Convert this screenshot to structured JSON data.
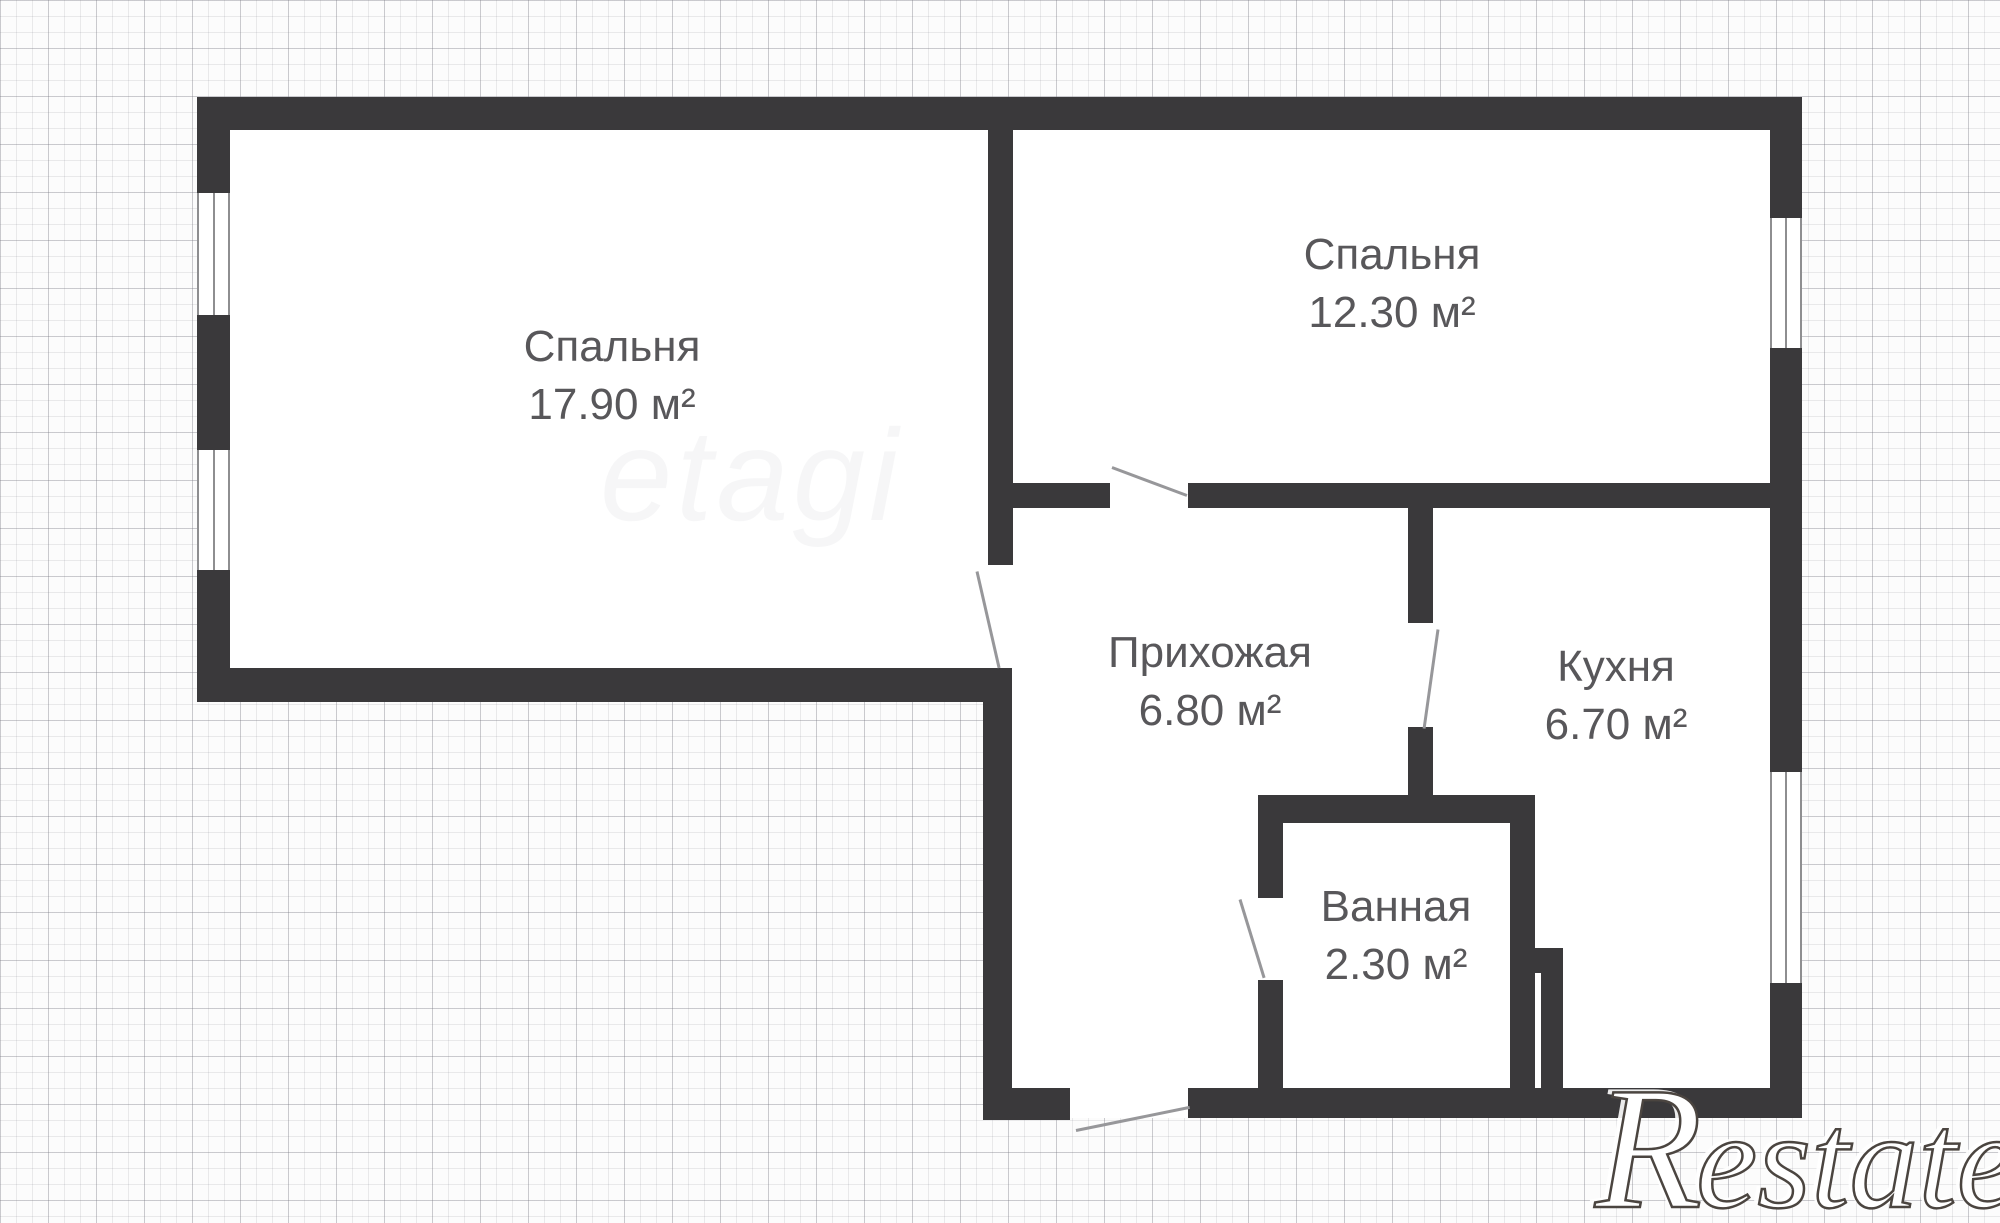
{
  "plan": {
    "rooms": [
      {
        "id": "bedroom-1",
        "name": "Спальня",
        "area": "17.90 м²"
      },
      {
        "id": "bedroom-2",
        "name": "Спальня",
        "area": "12.30 м²"
      },
      {
        "id": "hallway",
        "name": "Прихожая",
        "area": "6.80 м²"
      },
      {
        "id": "kitchen",
        "name": "Кухня",
        "area": "6.70 м²"
      },
      {
        "id": "bathroom",
        "name": "Ванная",
        "area": "2.30 м²"
      }
    ]
  },
  "watermarks": {
    "center": "etagi",
    "corner_initial": "R",
    "corner_rest": "estate"
  },
  "colors": {
    "wall": "#3a393b",
    "label_text": "#58575a",
    "door_line": "#97979a",
    "window_line": "#8e8e90",
    "grid_minor": "#ececef",
    "grid_major": "#d9d9dd",
    "interior": "#ffffff",
    "background": "#fcfcfc"
  }
}
